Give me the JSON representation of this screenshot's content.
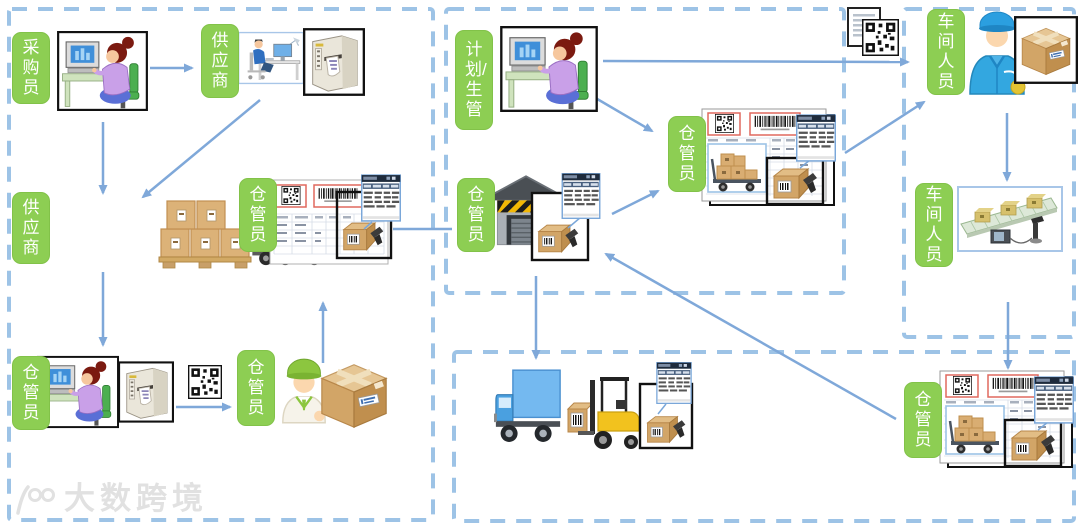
{
  "colors": {
    "label_bg": "#8DCE53",
    "label_text": "#FFFFFF",
    "region_border": "#9DC3E6",
    "arrow": "#7FA8D9"
  },
  "labels": [
    {
      "id": "purchaser",
      "text": "采购员"
    },
    {
      "id": "supplier-top",
      "text": "供应商"
    },
    {
      "id": "supplier-left",
      "text": "供应商"
    },
    {
      "id": "warehouse-keeper-receiving",
      "text": "仓管员"
    },
    {
      "id": "warehouse-keeper-label-print",
      "text": "仓管员"
    },
    {
      "id": "warehouse-keeper-putaway",
      "text": "仓管员"
    },
    {
      "id": "planner",
      "text": "计划/生管"
    },
    {
      "id": "warehouse-keeper-warehouse",
      "text": "仓管员"
    },
    {
      "id": "warehouse-keeper-issue",
      "text": "仓管员"
    },
    {
      "id": "workshop-staff-receive",
      "text": "车间人员"
    },
    {
      "id": "workshop-staff-line",
      "text": "车间人员"
    },
    {
      "id": "warehouse-keeper-return",
      "text": "仓管员"
    }
  ],
  "watermark": {
    "logo": "100",
    "text": "大数跨境"
  },
  "images": [
    "woman-at-computer",
    "supplier-at-desk",
    "label-printer",
    "pallet-of-boxes",
    "container-truck",
    "receiving-document-with-scanner",
    "qr-code",
    "warehouse-worker-with-box",
    "warehouse-with-scanner",
    "issue-document-with-scanner",
    "document-qr-icon",
    "workshop-worker-with-box",
    "conveyor-scanning-station",
    "box-truck",
    "forklift-with-scanner",
    "return-document-with-scanner"
  ]
}
